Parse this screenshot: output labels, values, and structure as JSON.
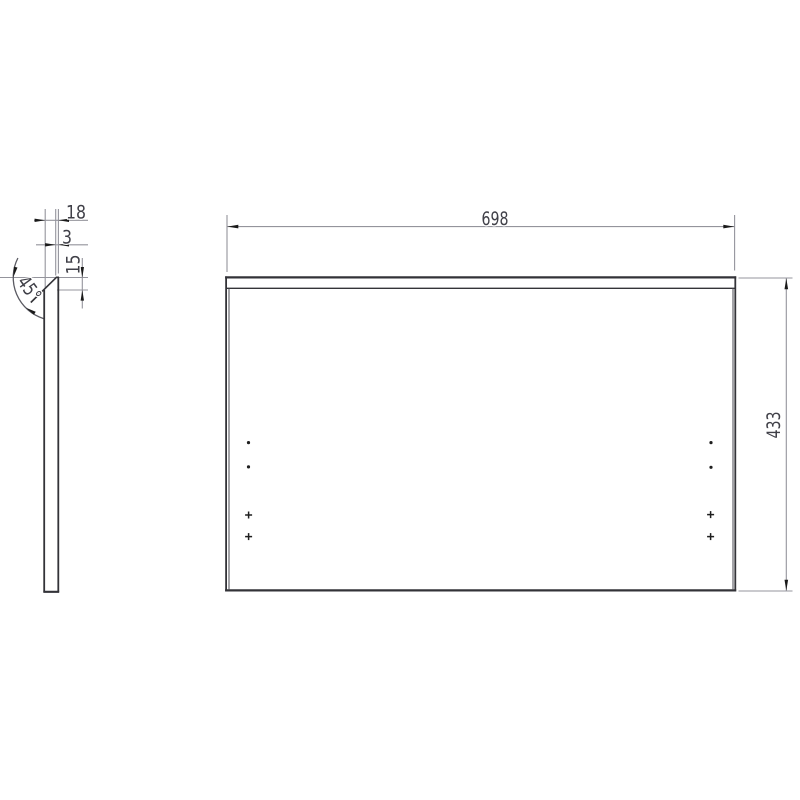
{
  "drawing": {
    "type": "technical-part-drawing",
    "background": "#ffffff",
    "colors": {
      "object_line": "#333338",
      "thin_object_line": "#4a4a50",
      "dimension_line": "#94949c",
      "angle_arc": "#5a5a62",
      "arrowhead": "#1a1a1a",
      "text": "#404048"
    },
    "labels": {
      "width": "698",
      "height": "433",
      "depth": "18",
      "top_flat": "3",
      "chamfer_height": "15",
      "chamfer_angle": "45°"
    },
    "views": {
      "side_profile": {
        "description_visible_dimensions": [
          {
            "name": "panel-depth",
            "value": "18"
          },
          {
            "name": "top-flat-thickness",
            "value": "3"
          },
          {
            "name": "chamfer-vertical-height",
            "value": "15"
          },
          {
            "name": "chamfer-angle",
            "value": "45°"
          }
        ]
      },
      "front": {
        "visible_dimensions": [
          {
            "name": "panel-width",
            "value": "698"
          },
          {
            "name": "panel-height",
            "value": "433"
          }
        ],
        "hole_markers": {
          "dot_marker_icon": "hole-dot-marker",
          "cross_marker_icon": "hole-cross-marker",
          "left_column_count": 4,
          "right_column_count": 4,
          "rows_from_top": [
            "dot",
            "dot",
            "cross",
            "cross"
          ]
        }
      }
    }
  }
}
